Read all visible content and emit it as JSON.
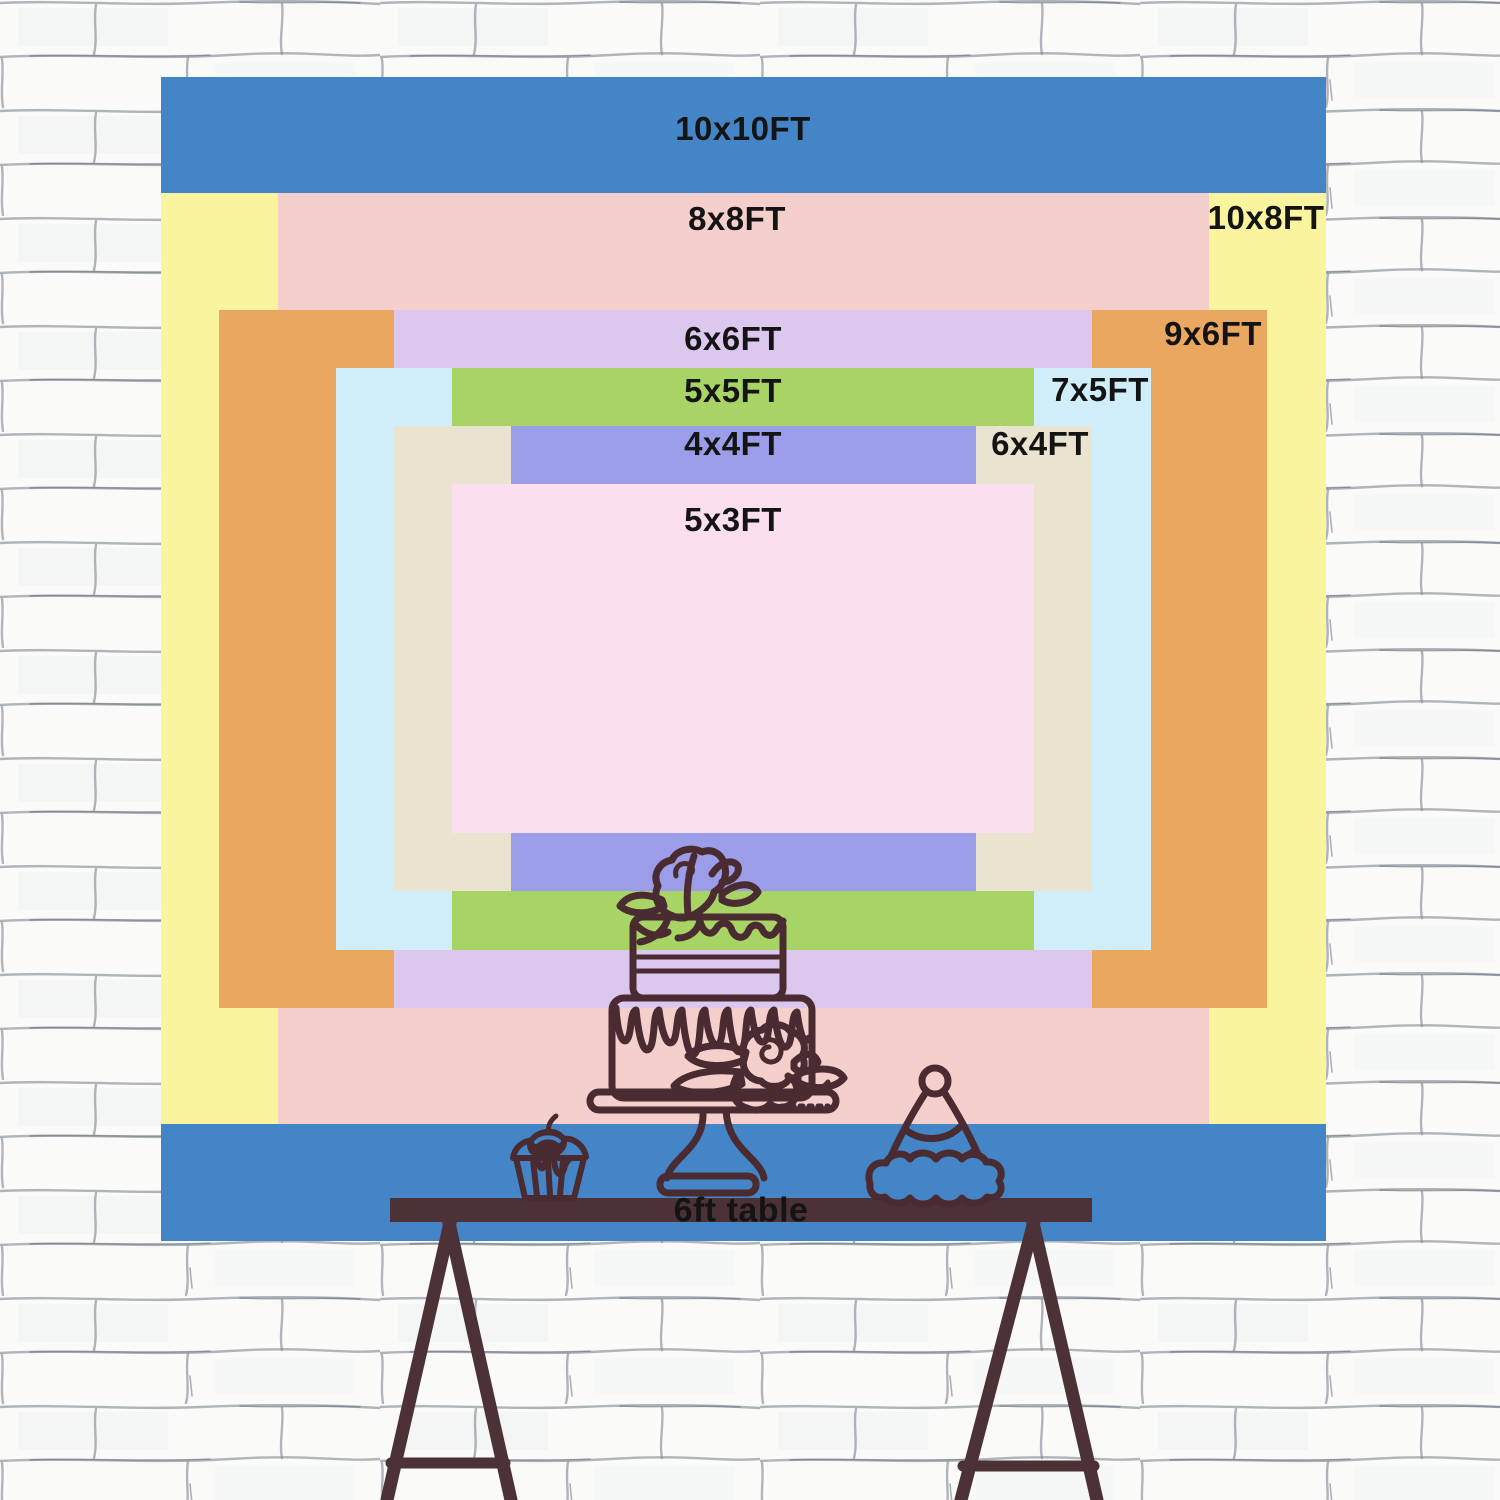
{
  "sizes": [
    {
      "label": "10x10FT",
      "width_ft": 10,
      "height_ft": 10,
      "color": "#4385c6"
    },
    {
      "label": "10x8FT",
      "width_ft": 10,
      "height_ft": 8,
      "color": "#faf49e"
    },
    {
      "label": "8x8FT",
      "width_ft": 8,
      "height_ft": 8,
      "color": "#f4cfcc"
    },
    {
      "label": "9x6FT",
      "width_ft": 9,
      "height_ft": 6,
      "color": "#e9a75f"
    },
    {
      "label": "6x6FT",
      "width_ft": 6,
      "height_ft": 6,
      "color": "#dcc8ee"
    },
    {
      "label": "7x5FT",
      "width_ft": 7,
      "height_ft": 5,
      "color": "#d0eef9"
    },
    {
      "label": "5x5FT",
      "width_ft": 5,
      "height_ft": 5,
      "color": "#a7d464"
    },
    {
      "label": "6x4FT",
      "width_ft": 6,
      "height_ft": 4,
      "color": "#eae3cf"
    },
    {
      "label": "4x4FT",
      "width_ft": 4,
      "height_ft": 4,
      "color": "#9c9de8"
    },
    {
      "label": "5x3FT",
      "width_ft": 5,
      "height_ft": 3,
      "color": "#fbdfee"
    }
  ],
  "table": {
    "label": "6ft table"
  },
  "illustrations": [
    "two-tier-cake-on-stand",
    "cupcake-with-cherry",
    "party-hat",
    "trestle-table"
  ],
  "colors": {
    "label_text": "#141414",
    "line_art": "#4a2b31",
    "table_top": "#4c3236",
    "wall_bg": "#fafaf8",
    "brick_line": "#878d99"
  }
}
